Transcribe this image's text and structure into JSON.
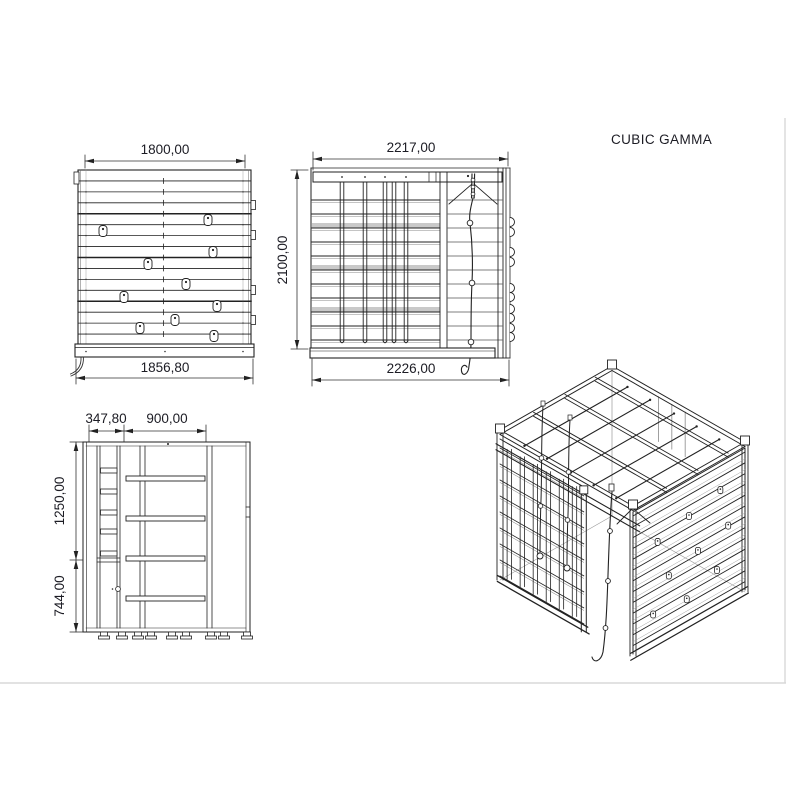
{
  "title": "CUBIC GAMMA",
  "front_view": {
    "dim_width_top": "1800,00",
    "dim_width_bottom": "1856,80"
  },
  "rear_view": {
    "dim_width_top": "2217,00",
    "dim_height_left": "2100,00",
    "dim_width_bottom": "2226,00"
  },
  "plan_view": {
    "dim_offset_left": "347,80",
    "dim_span_center": "900,00",
    "dim_depth_upper": "1250,00",
    "dim_depth_lower": "744,00"
  }
}
